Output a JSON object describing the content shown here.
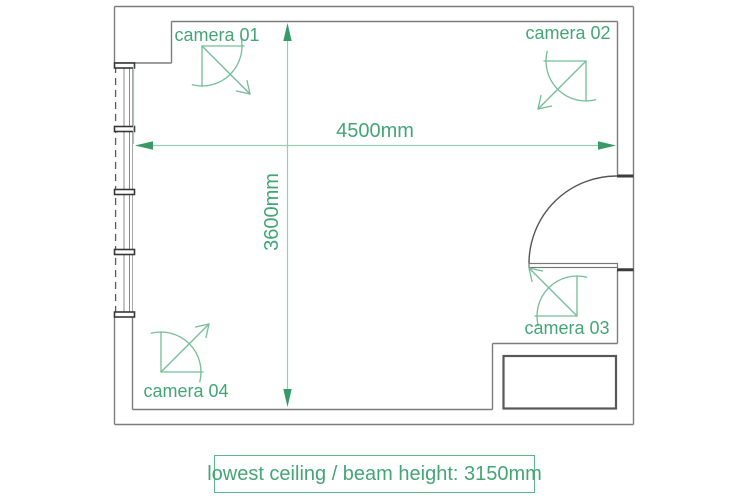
{
  "plan": {
    "type": "room floor plan with cctv camera coverage",
    "dimensions": {
      "width_label": "4500mm",
      "height_label": "3600mm",
      "width_mm": 4500,
      "height_mm": 3600
    },
    "cameras": [
      {
        "label": "camera 01"
      },
      {
        "label": "camera 02"
      },
      {
        "label": "camera 03"
      },
      {
        "label": "camera 04"
      }
    ],
    "note": {
      "text": "lowest ceiling / beam height: 3150mm",
      "value_mm": 3150
    },
    "colors": {
      "dimension_green": "#44a577",
      "arrow_green": "#379a67",
      "icon_green": "#74bd98",
      "wall_grey": "#7d7d7d",
      "heavy_grey": "#3c3c3c",
      "background": "#ffffff"
    }
  }
}
